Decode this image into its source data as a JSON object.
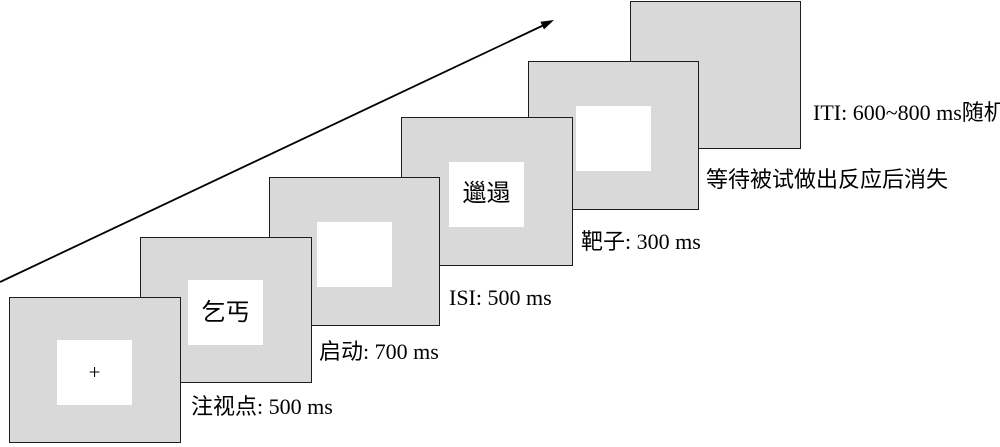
{
  "figure": {
    "type": "experiment-trial-sequence",
    "frames": [
      {
        "id": "fixation",
        "stimulus": "+",
        "label": "注视点: 500 ms"
      },
      {
        "id": "prime",
        "stimulus": "乞丐",
        "label": "启动: 700 ms"
      },
      {
        "id": "isi",
        "stimulus": "",
        "label": "ISI: 500 ms"
      },
      {
        "id": "target",
        "stimulus": "邋遢",
        "label": "靶子: 300 ms"
      },
      {
        "id": "response",
        "stimulus": "",
        "label": "等待被试做出反应后消失"
      },
      {
        "id": "iti",
        "stimulus": null,
        "label": "ITI: 600~800 ms随机"
      }
    ],
    "colors": {
      "frame_fill": "#d9d9d9",
      "frame_border": "#1c1c1c",
      "stimulus_box_fill": "#ffffff",
      "text": "#000000",
      "arrow": "#000000"
    }
  }
}
